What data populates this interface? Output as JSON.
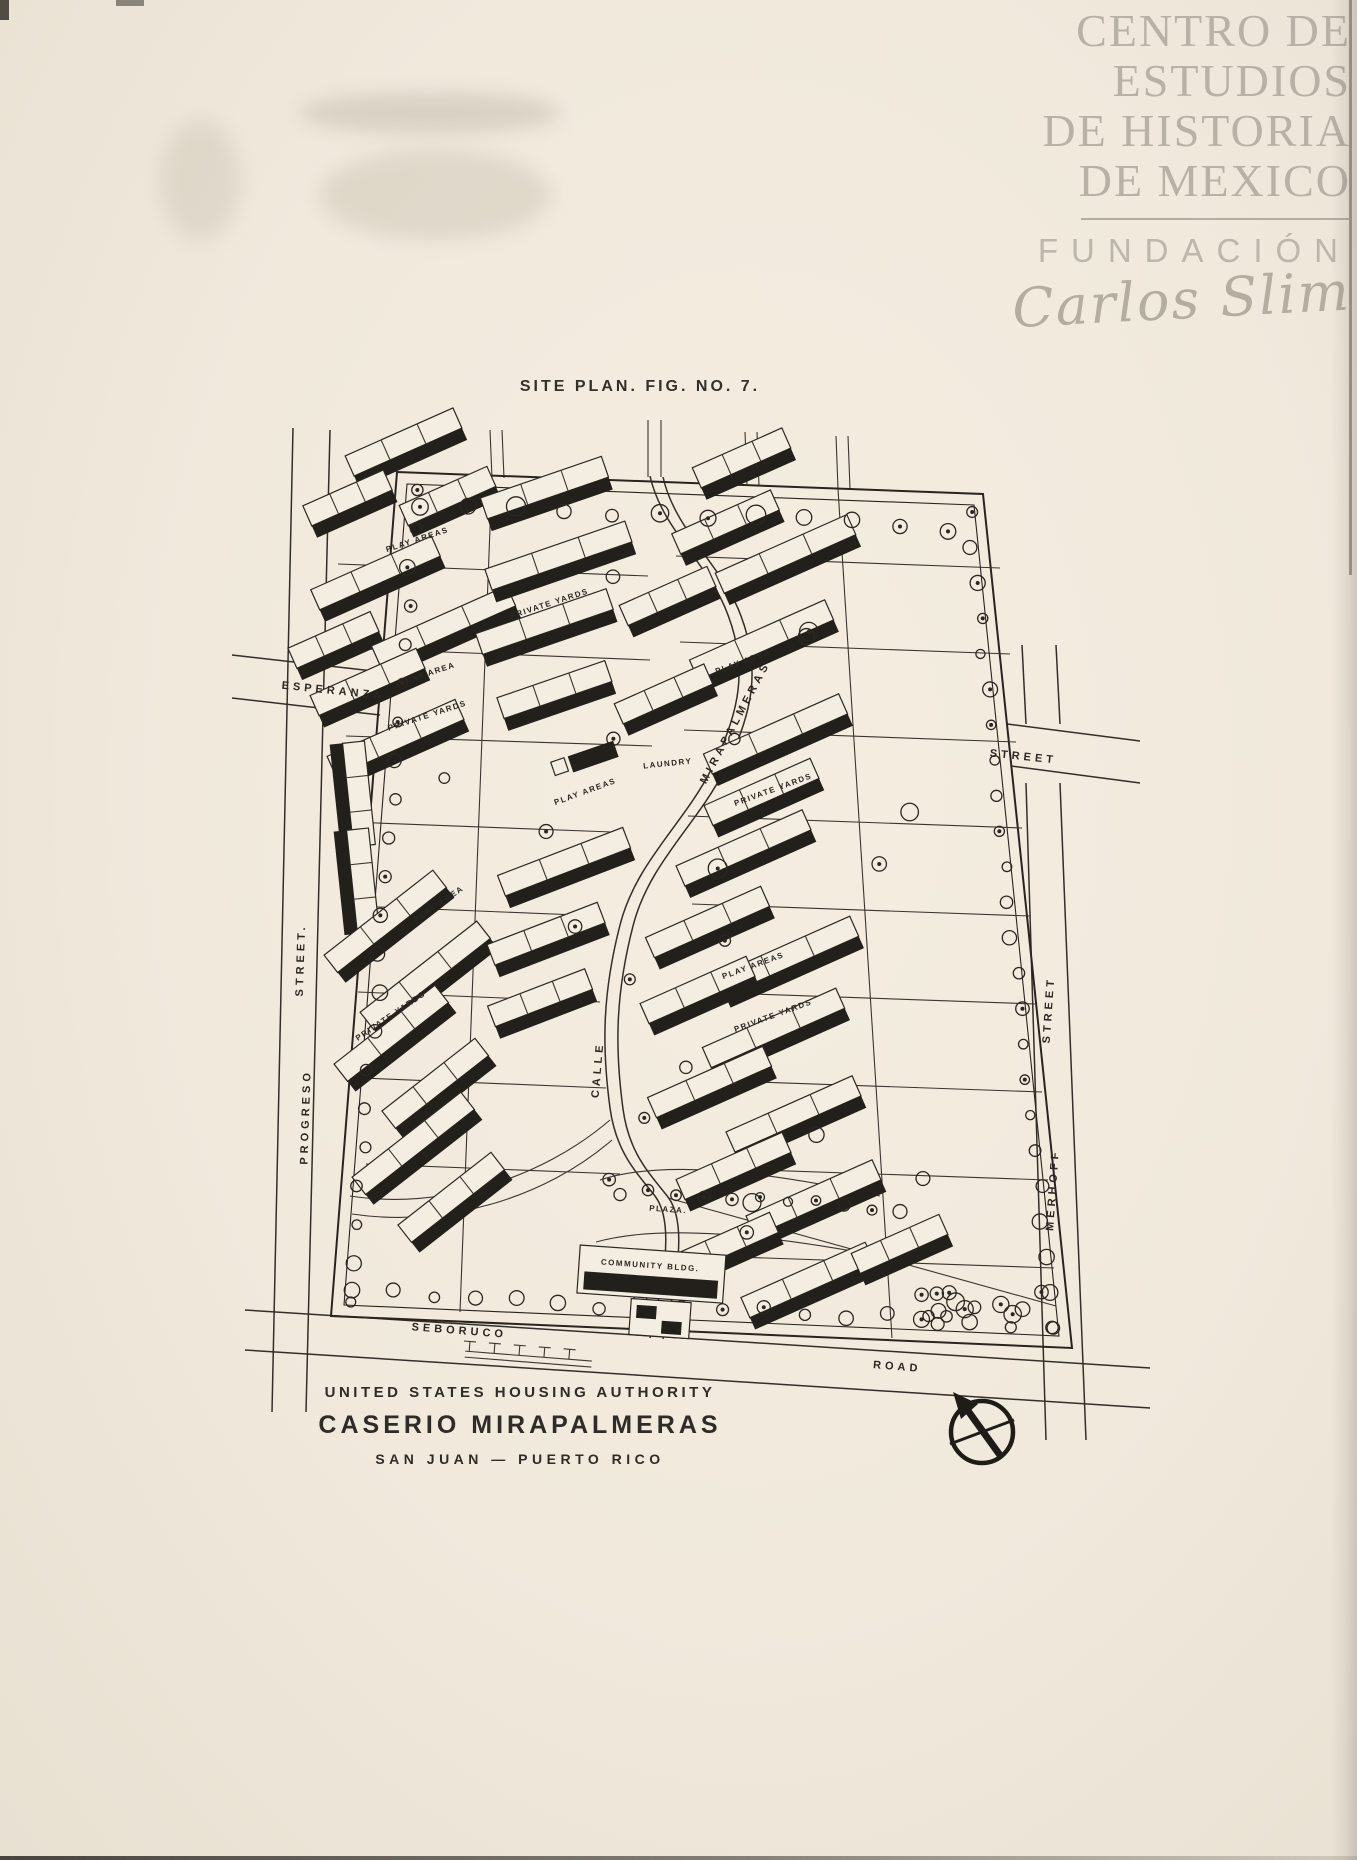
{
  "watermark": {
    "line1": "CENTRO DE",
    "line2": "ESTUDIOS",
    "line3": "DE HISTORIA",
    "line4": "DE MEXICO",
    "foundation": "FUNDACIÓN",
    "signature": "Carlos Slim",
    "text_color": "#b7b1a6"
  },
  "figure_title": "SITE PLAN. FIG. NO. 7.",
  "map": {
    "street_labels": {
      "esperanza": "ESPERANZA",
      "street_top_right": "STREET",
      "progreso": "PROGRESO",
      "progreso_suffix": "STREET.",
      "merhoff": "MERHOFF",
      "merhoff_suffix": "STREET",
      "seboruco": "SEBORUCO",
      "road": "ROAD",
      "calle": "CALLE",
      "mirapalmeras": "MIRAPALMERAS"
    },
    "site_labels": [
      {
        "text": "PLAY AREAS",
        "x": 418,
        "y": 542,
        "rot": -18
      },
      {
        "text": "PRIVATE YARDS",
        "x": 550,
        "y": 606,
        "rot": -18
      },
      {
        "text": "PLAY AREA",
        "x": 744,
        "y": 664,
        "rot": -20
      },
      {
        "text": "PLAY AREA",
        "x": 428,
        "y": 676,
        "rot": -18
      },
      {
        "text": "PRIVATE YARDS",
        "x": 428,
        "y": 718,
        "rot": -18
      },
      {
        "text": "LAUNDRY",
        "x": 668,
        "y": 766,
        "rot": -6
      },
      {
        "text": "PLAY AREAS",
        "x": 586,
        "y": 794,
        "rot": -20
      },
      {
        "text": "PRIVATE YARDS",
        "x": 774,
        "y": 792,
        "rot": -20
      },
      {
        "text": "PLAY AREA",
        "x": 440,
        "y": 906,
        "rot": -34
      },
      {
        "text": "PLAY AREAS",
        "x": 754,
        "y": 968,
        "rot": -20
      },
      {
        "text": "PRIVATE YARDS",
        "x": 392,
        "y": 1018,
        "rot": -34
      },
      {
        "text": "PRIVATE YARDS",
        "x": 774,
        "y": 1018,
        "rot": -20
      },
      {
        "text": "PLAZA.",
        "x": 668,
        "y": 1212,
        "rot": 4
      },
      {
        "text": "COMMUNITY BLDG.",
        "x": 650,
        "y": 1268,
        "rot": 4
      }
    ]
  },
  "caption": {
    "agency": "UNITED STATES HOUSING AUTHORITY",
    "project": "CASERIO MIRAPALMERAS",
    "location": "SAN JUAN — PUERTO RICO"
  },
  "colors": {
    "ink": "#2b2622",
    "paper": "#f0e9dc",
    "watermark": "#b7b1a6"
  }
}
